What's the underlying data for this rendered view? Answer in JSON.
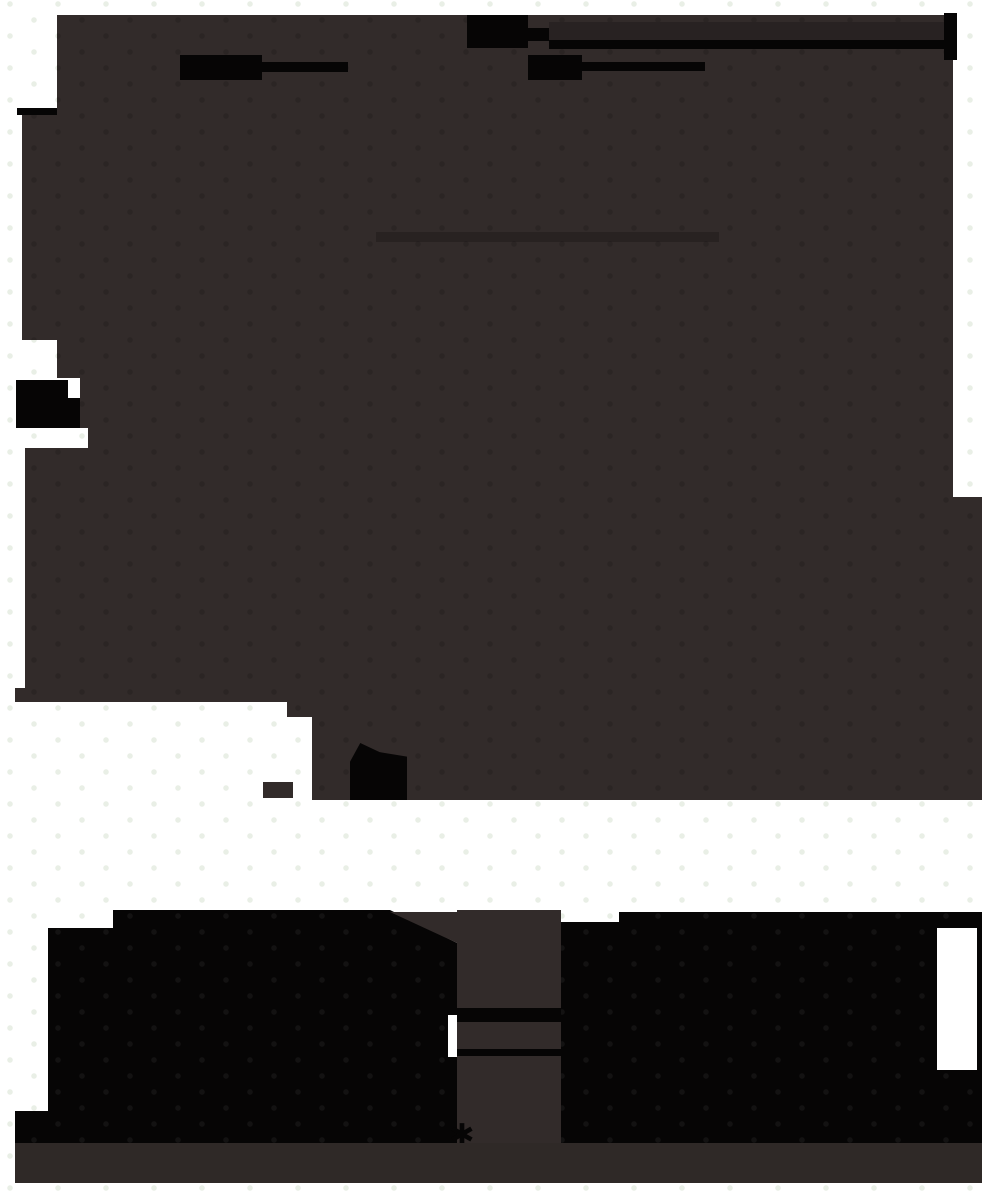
{
  "canvas": {
    "width": 982,
    "height": 1196
  },
  "colors": {
    "page-bg": "#ffffff",
    "panel-dark": "#322b2a",
    "panel-darker-band": "#2f2927",
    "ink-black": "#060505",
    "topbar-dark": "#282222",
    "halftone-light": "#e9efe6",
    "halftone-dark": "rgba(0,0,0,0.14)",
    "halftone-on-black": "rgba(255,255,255,0.05)",
    "inner-band": "rgba(0,0,0,0.20)"
  },
  "marks": {
    "asterisk_glyph": "✱"
  }
}
